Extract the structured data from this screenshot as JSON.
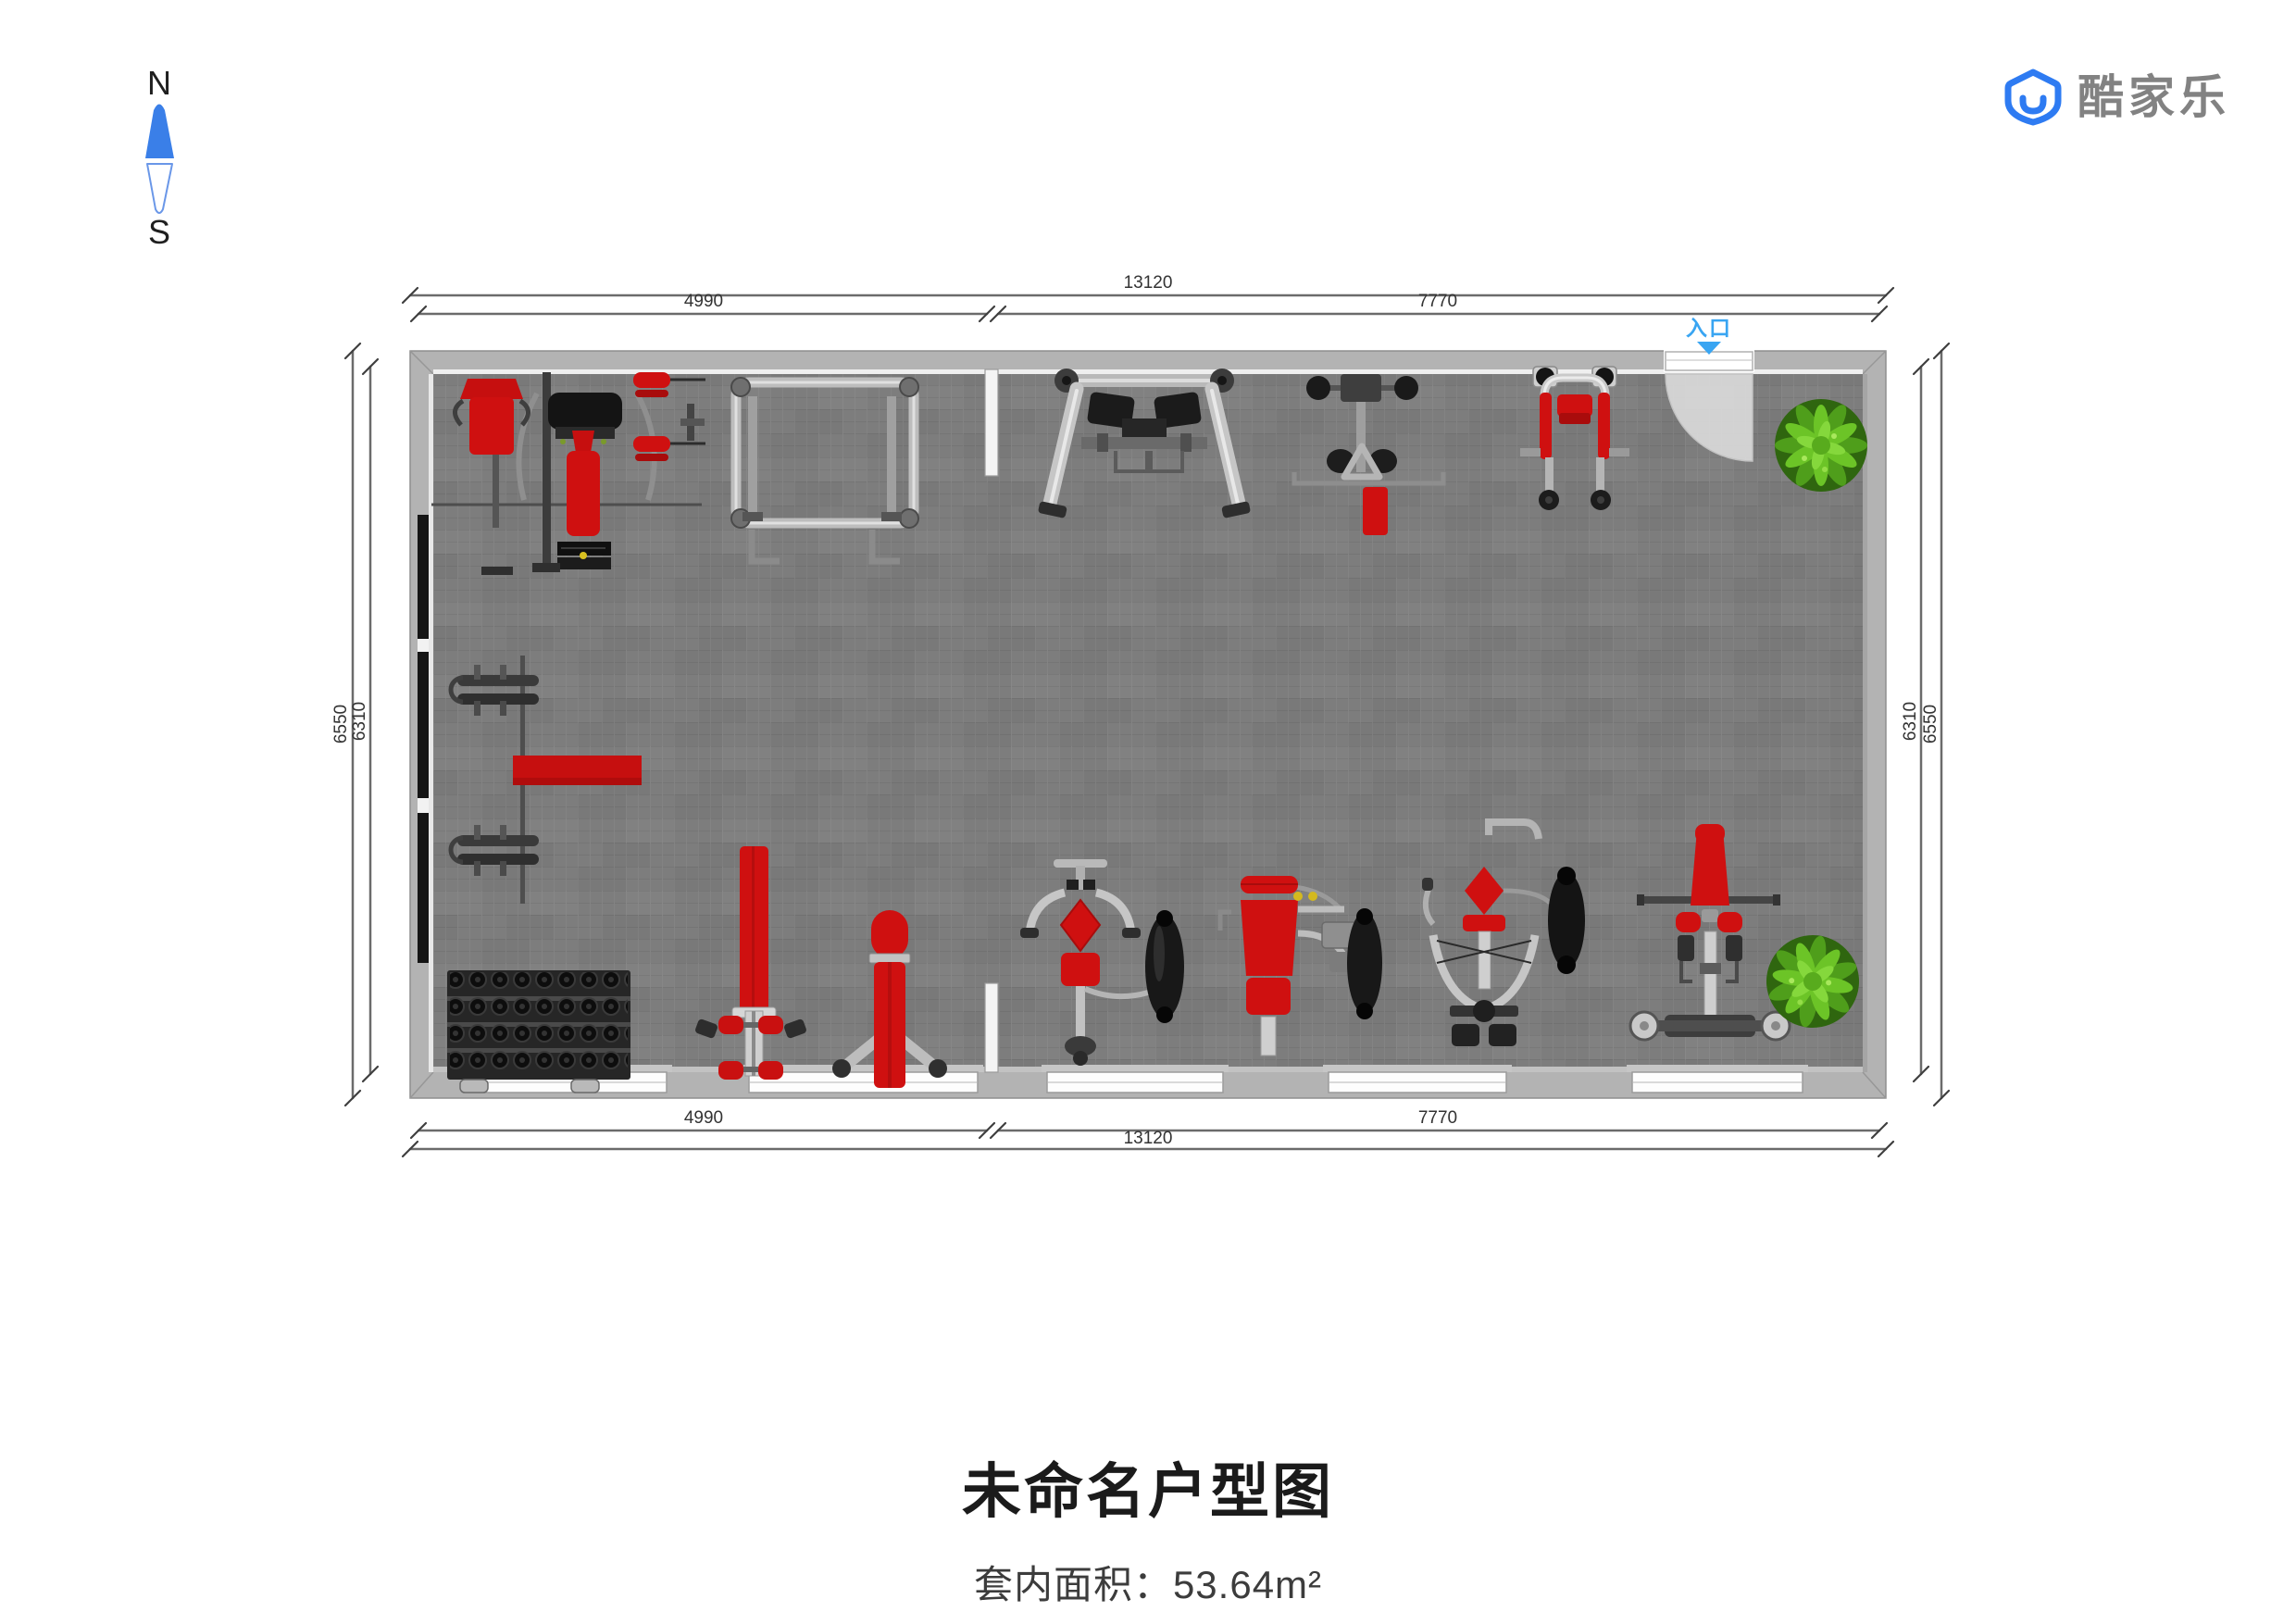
{
  "compass": {
    "north": "N",
    "south": "S"
  },
  "brand": {
    "name": "酷家乐",
    "logo_blue": "#2E7BF2",
    "text_gray": "#828282"
  },
  "floorplan": {
    "entrance_label": "入口",
    "dimensions": {
      "top_total": "13120",
      "top_left_segment": "4990",
      "top_right_segment": "7770",
      "bottom_left_segment": "4990",
      "bottom_right_segment": "7770",
      "bottom_total": "13120",
      "left_outer": "6550",
      "left_inner": "6310",
      "right_inner": "6310",
      "right_outer": "6550"
    },
    "equipment": [
      {
        "name": "multi-station-trainer"
      },
      {
        "name": "squat-rack"
      },
      {
        "name": "hack-squat-machine"
      },
      {
        "name": "t-bar-row-machine"
      },
      {
        "name": "assisted-dip-machine"
      },
      {
        "name": "barbell-set-upper"
      },
      {
        "name": "barbell-set-lower"
      },
      {
        "name": "exercise-mat"
      },
      {
        "name": "dumbbell-rack"
      },
      {
        "name": "ab-bench"
      },
      {
        "name": "flat-bench"
      },
      {
        "name": "lat-pulldown-machine"
      },
      {
        "name": "chest-press-machine"
      },
      {
        "name": "pec-fly-machine"
      },
      {
        "name": "roman-chair-bench"
      },
      {
        "name": "potted-plant-north"
      },
      {
        "name": "potted-plant-south"
      }
    ]
  },
  "footer": {
    "title": "未命名户型图",
    "area_text": "套内面积：53.64m²"
  },
  "colors": {
    "accent_red": "#CF1010",
    "floor_gray": "#7D7D7D",
    "wall_gray": "#B3B3B3",
    "entrance_blue": "#39A5F2",
    "plant_green": "#5BB71E",
    "dimension_line": "#6B6B6B"
  }
}
